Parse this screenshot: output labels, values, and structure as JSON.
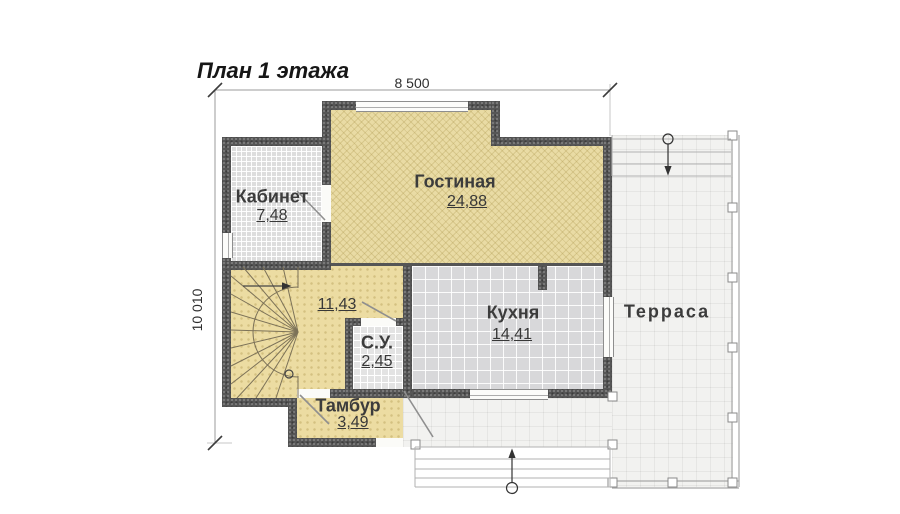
{
  "title": "План 1 этажа",
  "dimensions": {
    "width": "8 500",
    "height": "10 010"
  },
  "rooms": {
    "kabinet": {
      "name": "Кабинет",
      "area": "7,48"
    },
    "gostinaya": {
      "name": "Гостиная",
      "area": "24,88"
    },
    "hall": {
      "area": "11,43"
    },
    "su": {
      "name": "С.У.",
      "area": "2,45"
    },
    "kitchen": {
      "name": "Кухня",
      "area": "14,41"
    },
    "tambur": {
      "name": "Тамбур",
      "area": "3,49"
    },
    "terrace": {
      "name": "Терраса"
    }
  },
  "colors": {
    "wall": "#565656",
    "parquet_floor": "#e9dba4",
    "tile_floor": "#dddddd",
    "kitchen_floor": "#d8d8da",
    "terrace_floor": "#f2f2f0",
    "dimension_text": "#2e2e2e"
  }
}
